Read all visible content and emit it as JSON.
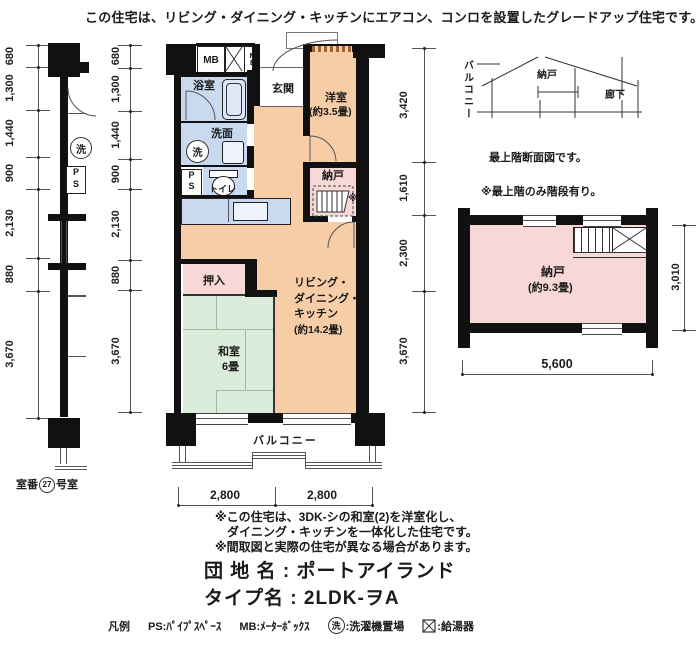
{
  "page": {
    "caption": "この住宅は、リビング・ダイニング・キッチンにエアコン、コンロを設置したグレードアップ住宅です。"
  },
  "colors": {
    "room_orange": "#f6cda6",
    "room_pink": "#f8d7d7",
    "room_green": "#dcecdb",
    "fixture_blue": "#c9daf0",
    "wall_black": "#111111"
  },
  "elevation": {
    "dims": [
      "680",
      "1,300",
      "1,440",
      "900",
      "2,130",
      "880",
      "3,670"
    ],
    "wash_symbol": "洗",
    "ps_line1": "P",
    "ps_line2": "S",
    "room_caption_prefix": "室番",
    "room_number": "27",
    "room_caption_suffix": "号室"
  },
  "plan": {
    "dims_left": [
      "680",
      "1,300",
      "1,440",
      "900",
      "2,130",
      "880",
      "3,670"
    ],
    "dims_right": [
      "3,420",
      "1,610",
      "2,300",
      "3,670"
    ],
    "dims_bottom": [
      "2,800",
      "2,800"
    ],
    "mb1": "MB",
    "mb2": "MB",
    "bath": "浴室",
    "washroom": "洗面",
    "wash_symbol": "洗",
    "ps_line1": "P",
    "ps_line2": "S",
    "toilet": "トイレ",
    "entrance": "玄関",
    "western_room": "洋室",
    "western_room_size": "(約3.5畳)",
    "storage": "納戸",
    "storage_mark": "※",
    "ldk_lines": [
      "リビング・",
      "ダイニング・",
      "キッチン",
      "(約14.2畳)"
    ],
    "closet": "押入",
    "japanese_room": "和室",
    "japanese_room_size": "6畳",
    "balcony": "バルコニー"
  },
  "section": {
    "balcony": "バルコニー",
    "storage": "納戸",
    "corridor": "廊下",
    "caption": "最上階断面図です。",
    "note": "※最上階のみ階段有り。"
  },
  "top_room": {
    "name": "納戸",
    "size": "(約9.3畳)",
    "dim_right": "3,010",
    "dim_bottom": "5,600"
  },
  "notes": [
    "※この住宅は、3DK-シの和室(2)を洋室化し、",
    "　ダイニング・キッチンを一体化した住宅です。",
    "※間取図と実際の住宅が異なる場合があります。"
  ],
  "titles": {
    "estate": "団 地 名 : ポートアイランド",
    "type": "タイプ名 : 2LDK-ヲA"
  },
  "legend": {
    "title": "凡例",
    "ps": "PS:ﾊﾟｲﾌﾟｽﾍﾟｰｽ",
    "mb": "MB:ﾒｰﾀｰﾎﾞｯｸｽ",
    "wash_symbol": "洗",
    "wash_label": ":洗濯機置場",
    "heater_label": ":給湯器"
  }
}
